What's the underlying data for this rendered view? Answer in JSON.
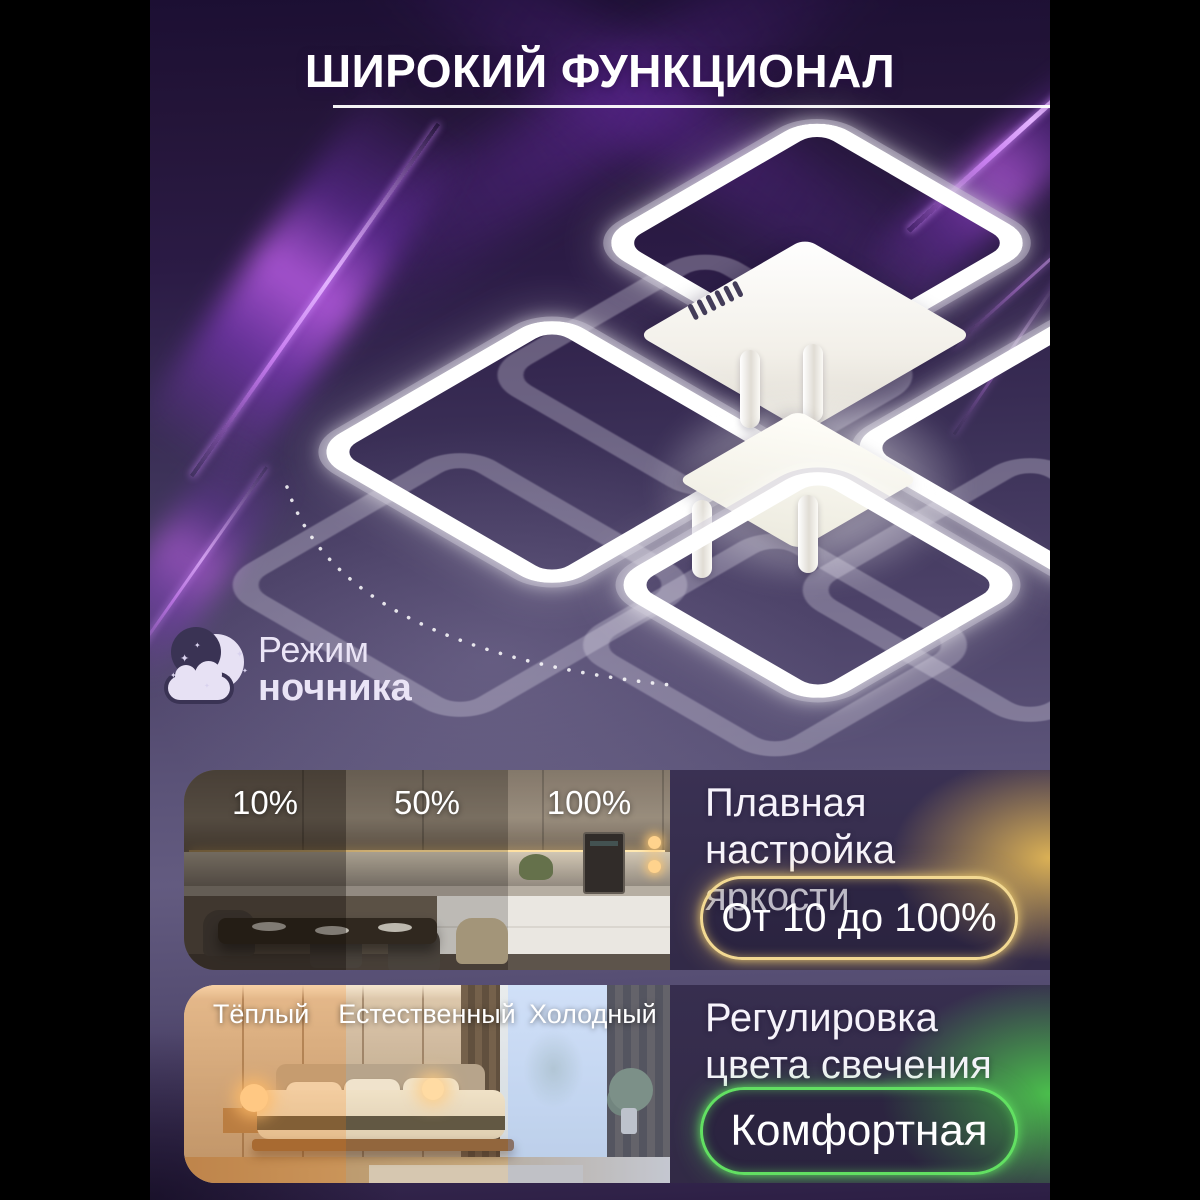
{
  "title": "ШИРОКИЙ ФУНКЦИОНАЛ",
  "night_mode": {
    "word1": "Режим",
    "word2": "ночника"
  },
  "brightness": {
    "photo_labels": [
      "10%",
      "50%",
      "100%"
    ],
    "heading_line1": "Плавная настройка",
    "heading_line2": "яркости",
    "badge": "От 10 до 100%",
    "accent_color": "#f0cf7c"
  },
  "color_temp": {
    "photo_labels": [
      "Тёплый",
      "Естественный",
      "Холодный"
    ],
    "heading_line1": "Регулировка",
    "heading_line2": "цвета свечения",
    "badge": "Комфортная",
    "accent_color": "#5fe05f"
  },
  "colors": {
    "background_purple_dark": "#241539",
    "background_purple_mid": "#5b5378",
    "neon_streak": "#c060f0",
    "gold_accent": "#f0cf7c",
    "green_accent": "#5fe05f",
    "lamp_white": "#ffffff"
  }
}
